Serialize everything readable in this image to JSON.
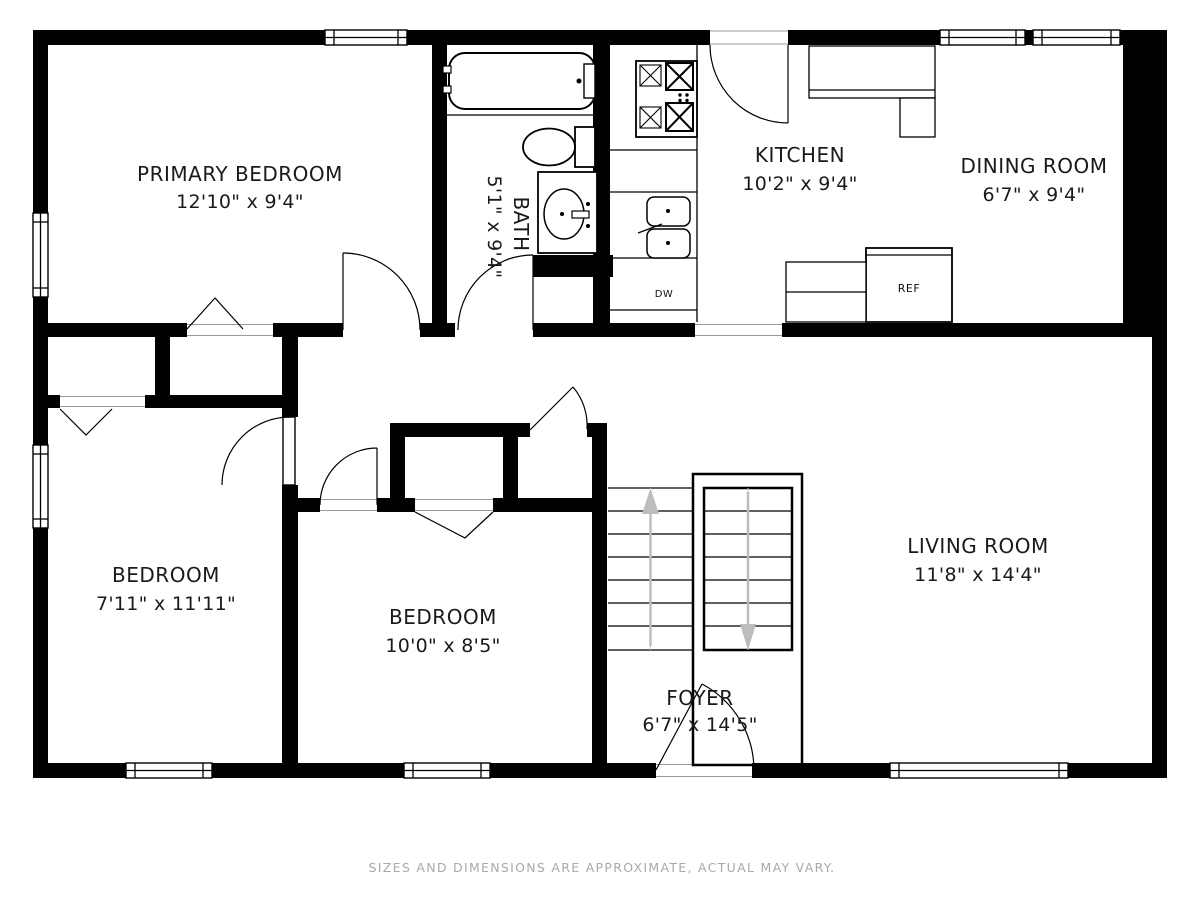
{
  "plan": {
    "rooms": {
      "primary_bedroom": {
        "name": "PRIMARY BEDROOM",
        "dims": "12'10\" x 9'4\""
      },
      "bath": {
        "name": "BATH",
        "dims": "5'1\" x 9'4\""
      },
      "kitchen": {
        "name": "KITCHEN",
        "dims": "10'2\" x 9'4\""
      },
      "dining_room": {
        "name": "DINING ROOM",
        "dims": "6'7\" x 9'4\""
      },
      "bedroom_left": {
        "name": "BEDROOM",
        "dims": "7'11\" x 11'11\""
      },
      "bedroom_middle": {
        "name": "BEDROOM",
        "dims": "10'0\" x 8'5\""
      },
      "living_room": {
        "name": "LIVING ROOM",
        "dims": "11'8\" x 14'4\""
      },
      "foyer": {
        "name": "FOYER",
        "dims": "6'7\" x 14'5\""
      }
    },
    "appliances": {
      "refrigerator": "REF",
      "dishwasher": "DW"
    },
    "disclaimer": "SIZES AND DIMENSIONS ARE APPROXIMATE, ACTUAL MAY VARY.",
    "colors": {
      "wall": "#000000",
      "background": "#ffffff",
      "stair_arrow": "#bdbdbd",
      "disclaimer_text": "#a9a9a9"
    }
  }
}
